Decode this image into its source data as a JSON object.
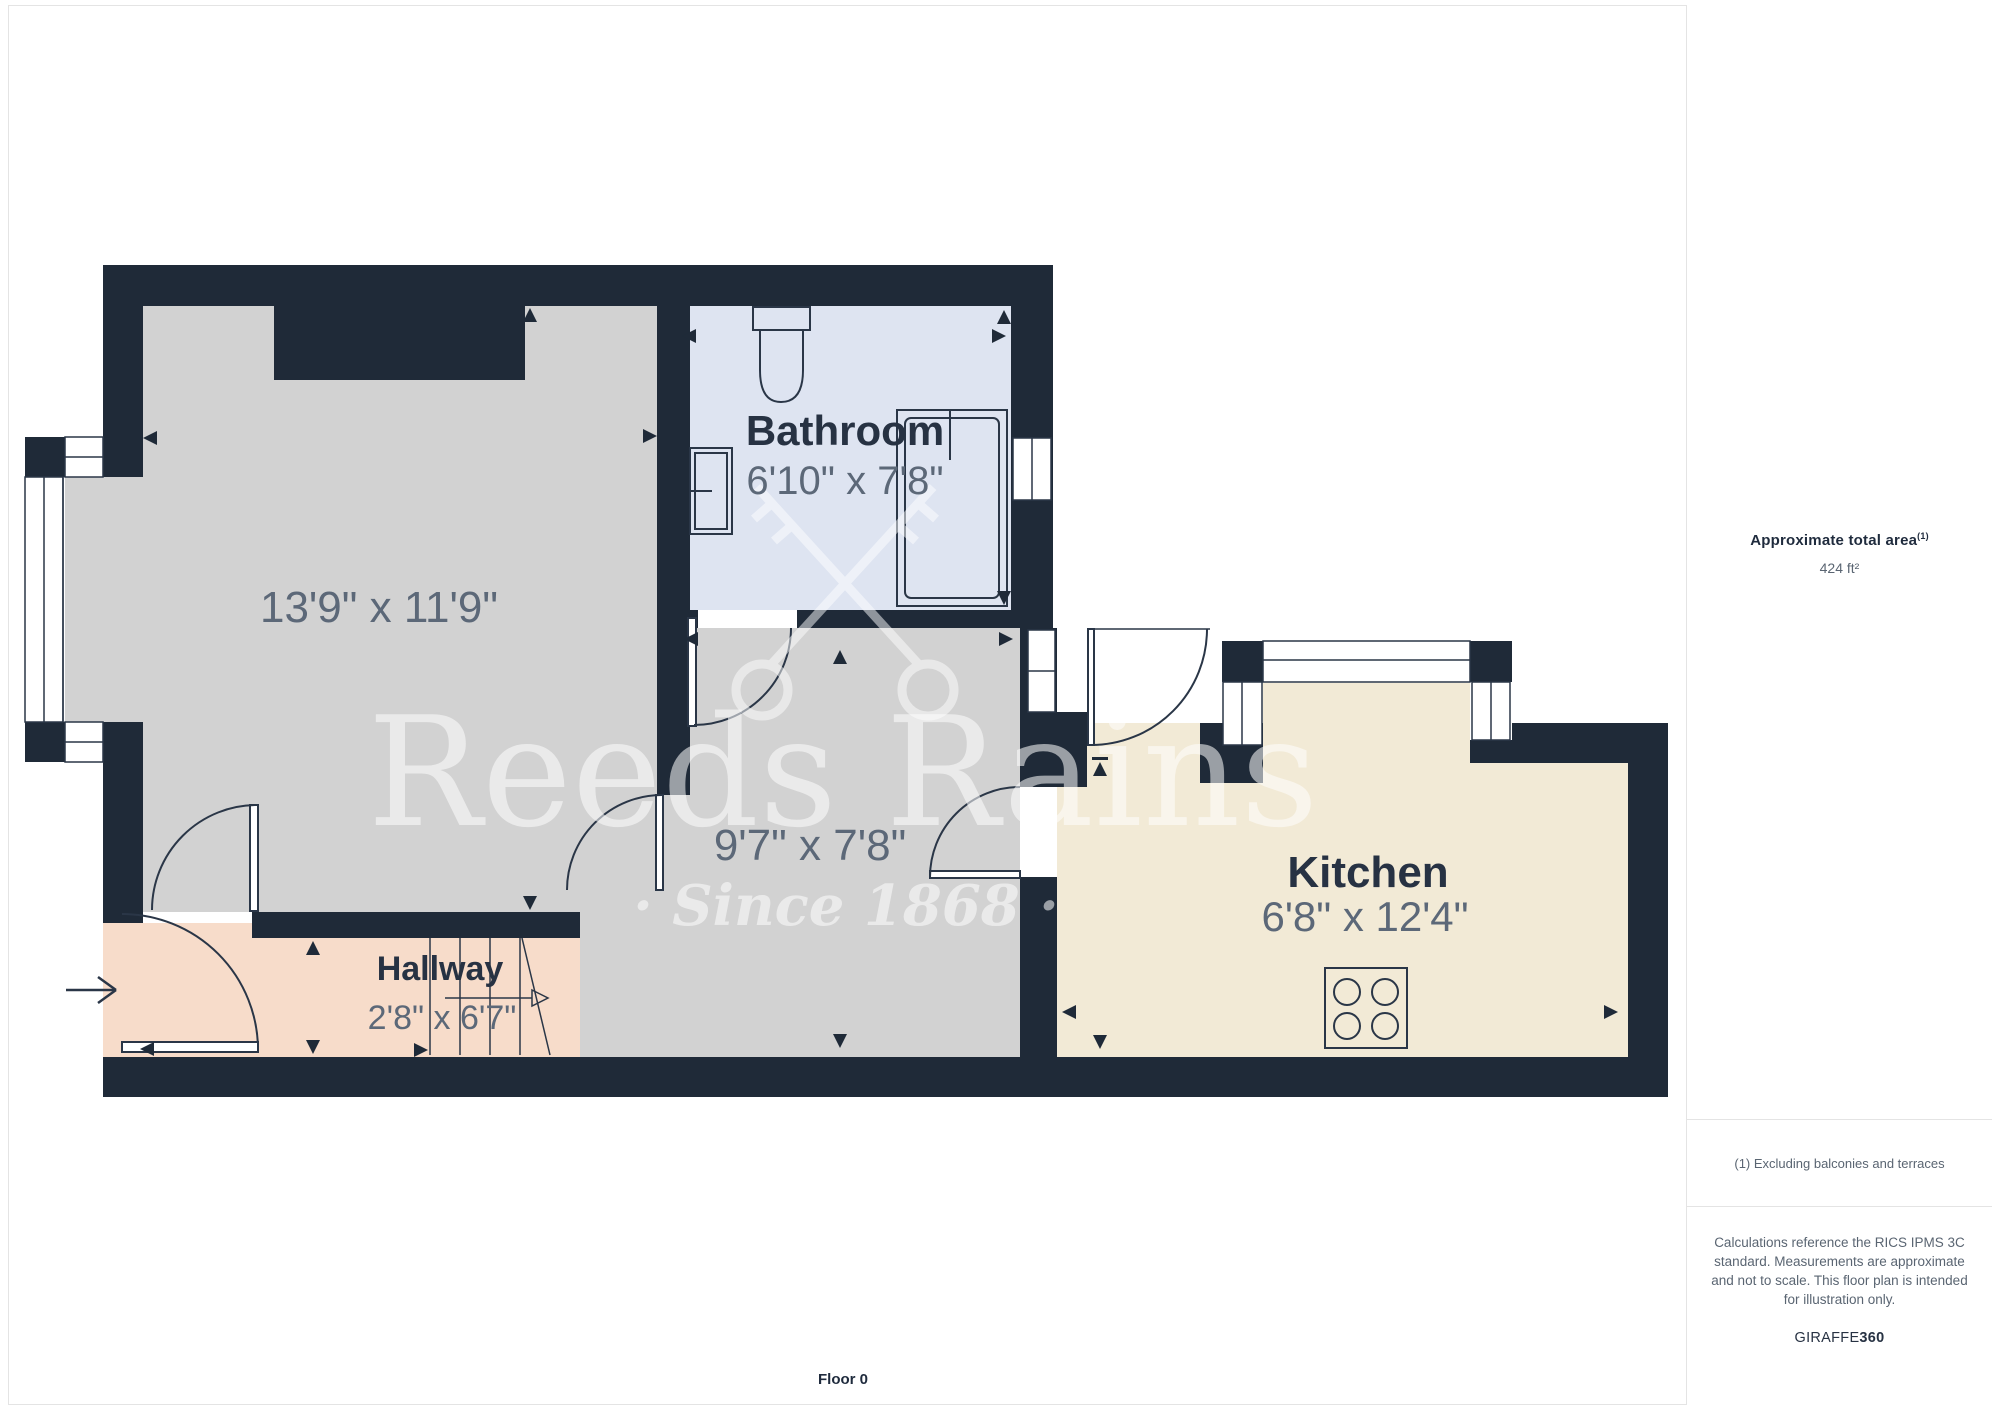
{
  "sidebar": {
    "area_label": "Approximate total area",
    "area_superscript": "(1)",
    "area_value": "424 ft²",
    "footnote": "(1) Excluding balconies and terraces",
    "disclaimer": "Calculations reference the RICS IPMS 3C standard. Measurements are approximate and not to scale. This floor plan is intended for illustration only.",
    "brand_name": "GIRAFFE",
    "brand_suffix": "360"
  },
  "plan": {
    "floor_label": "Floor 0",
    "watermark_brand": "Reeds Rains",
    "watermark_tagline": "· Since 1868 ·",
    "rooms": [
      {
        "name": "",
        "dims": "13'9\" x 11'9\""
      },
      {
        "name": "Bathroom",
        "dims": "6'10\" x 7'8\""
      },
      {
        "name": "",
        "dims": "9'7\" x 7'8\""
      },
      {
        "name": "Hallway",
        "dims": "2'8\" x 6'7\""
      },
      {
        "name": "Kitchen",
        "dims": "6'8\" x 12'4\""
      }
    ]
  },
  "colors": {
    "wall": "#1f2a38",
    "room_gray": "#d2d2d2",
    "bathroom": "#dee4f1",
    "hallway": "#f7dcca",
    "kitchen": "#f2ead6",
    "line": "#2a3647",
    "dim_text": "#5c6878",
    "name_text": "#273243",
    "watermark": "#ffffff",
    "border": "#e4e4e4",
    "sidebar_heading": "#1f2b3d",
    "sidebar_text": "#5a6572"
  }
}
